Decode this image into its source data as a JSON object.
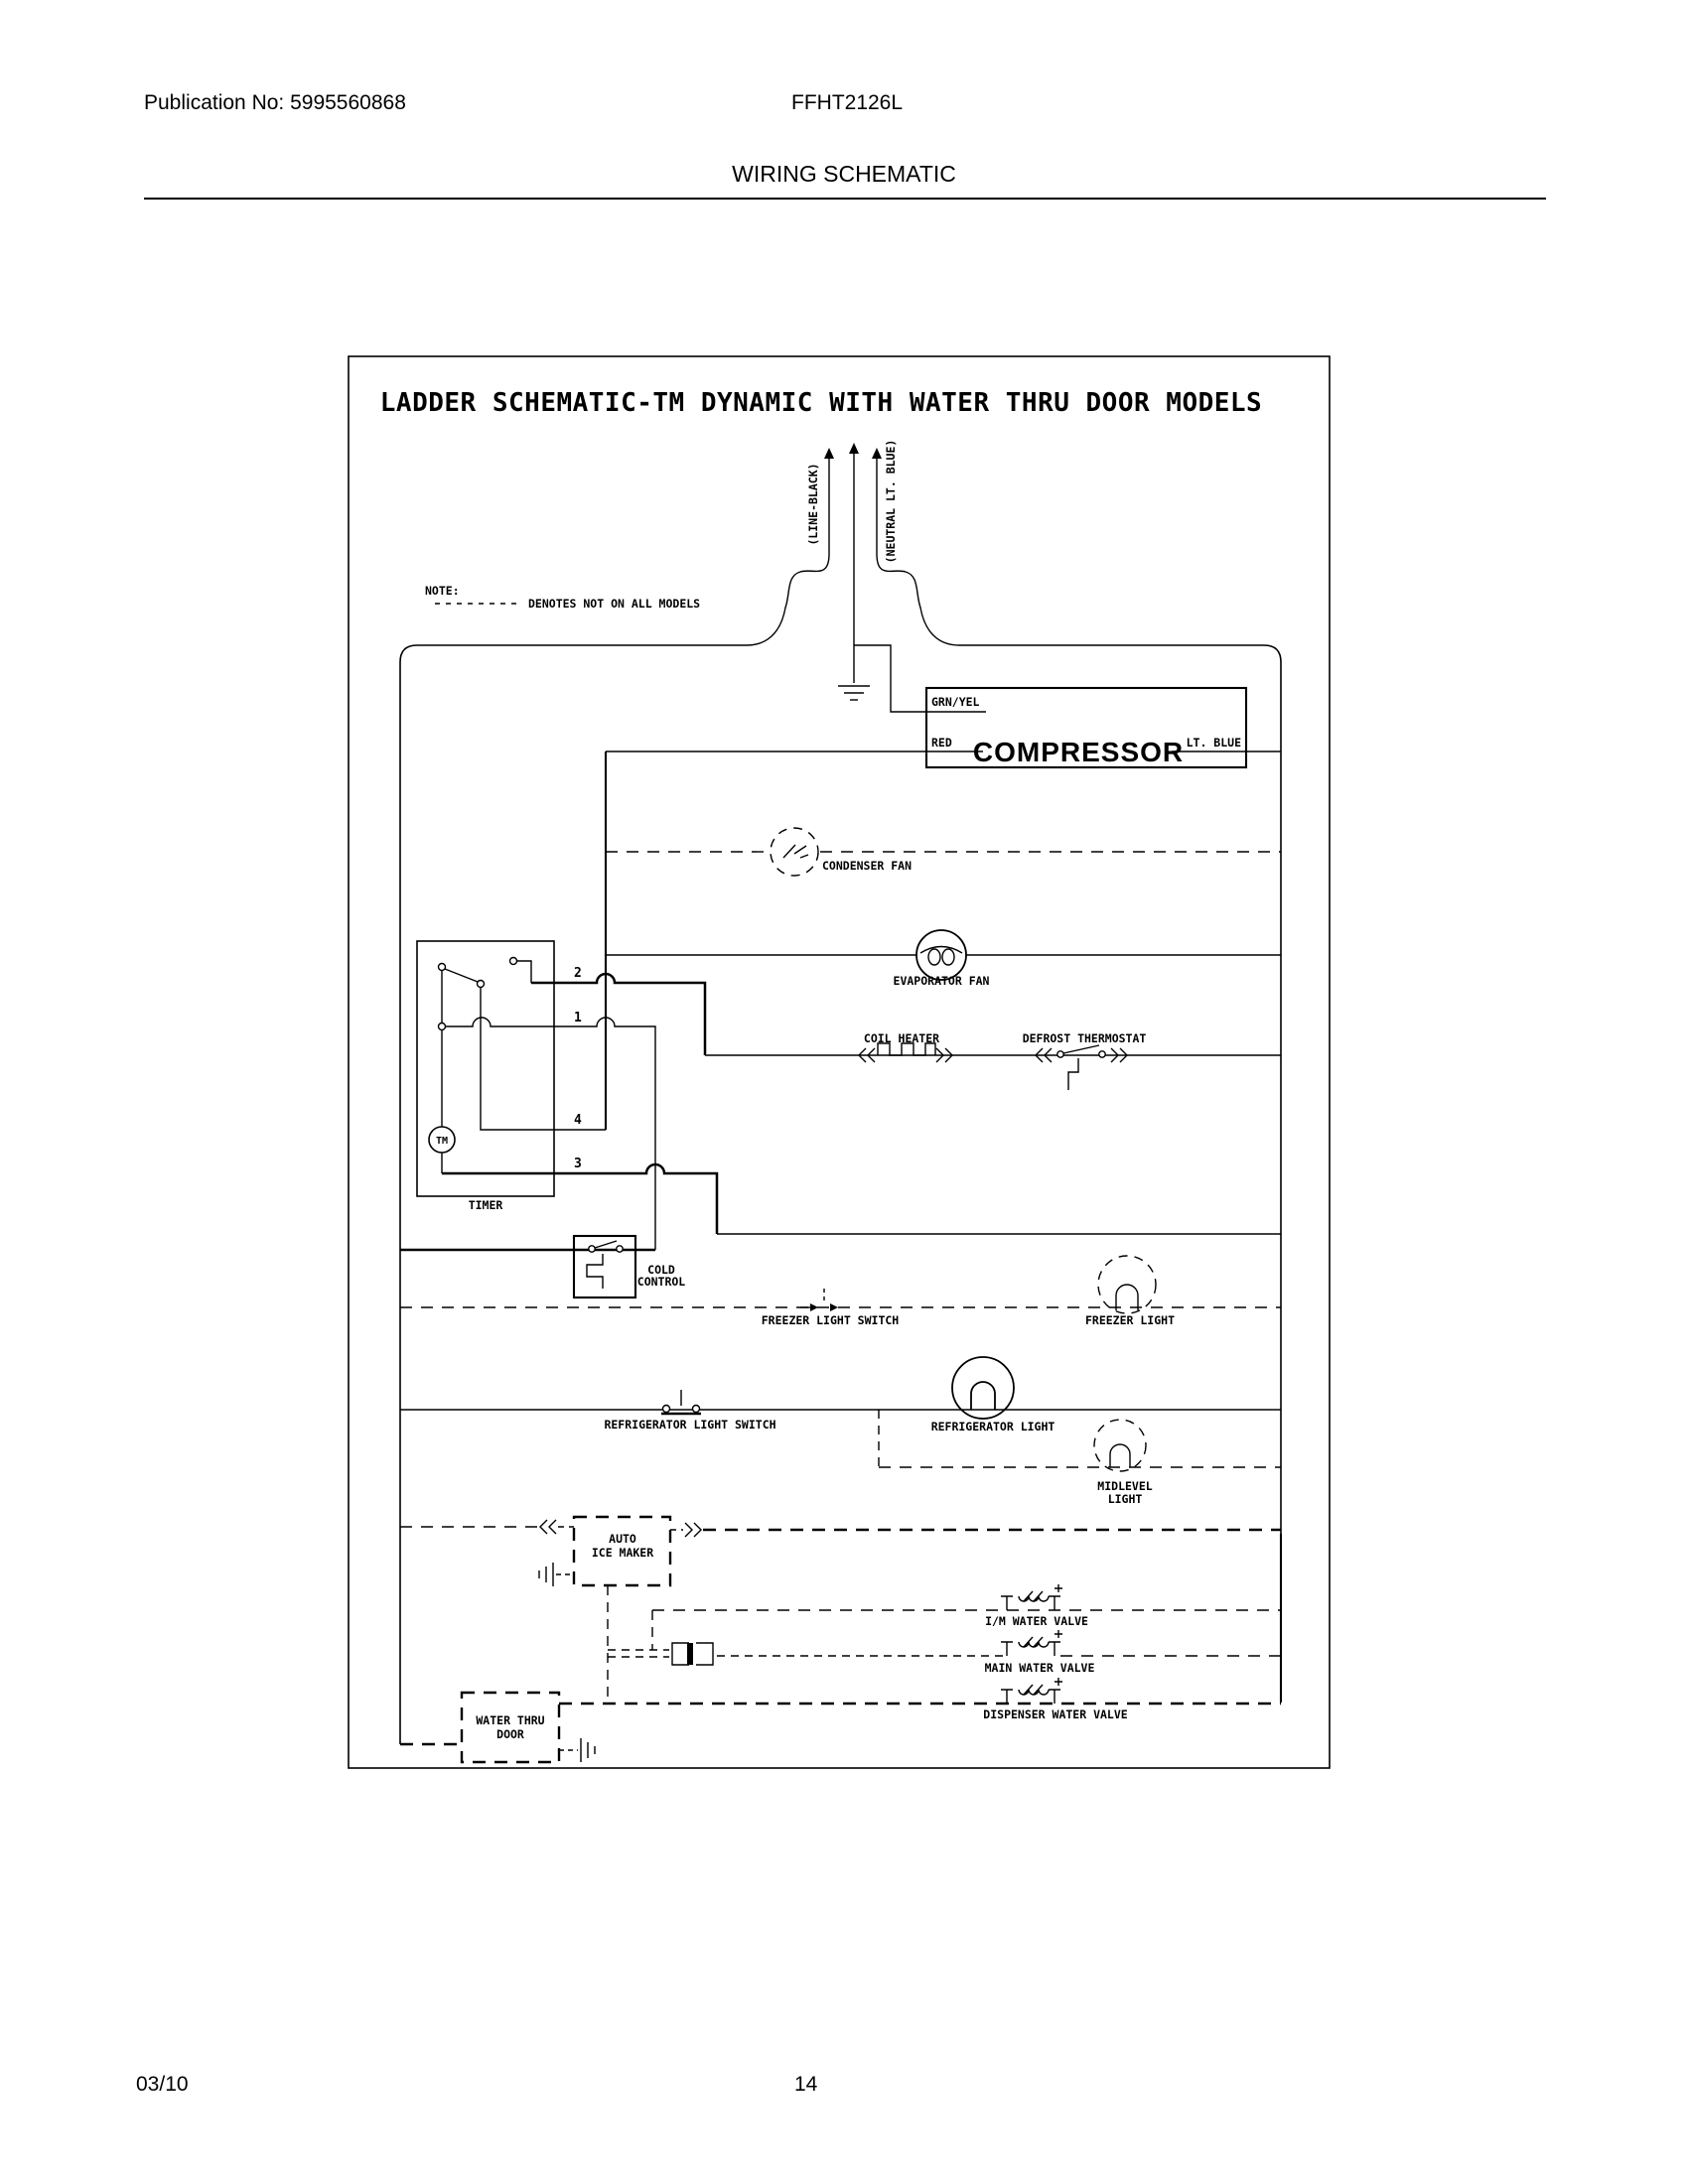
{
  "header": {
    "publication": "Publication No: 5995560868",
    "model": "FFHT2126L",
    "title": "WIRING SCHEMATIC"
  },
  "footer": {
    "date": "03/10",
    "page": "14"
  },
  "schematic": {
    "title": "LADDER SCHEMATIC-TM DYNAMIC WITH WATER THRU DOOR MODELS",
    "note": {
      "label": "NOTE:",
      "text": "DENOTES NOT ON ALL MODELS"
    },
    "supply": {
      "line": "(LINE-BLACK)",
      "neutral": "(NEUTRAL LT. BLUE)"
    },
    "compressor": {
      "name": "COMPRESSOR",
      "grn": "GRN/YEL",
      "red": "RED",
      "blue": "LT. BLUE"
    },
    "timer": {
      "name": "TIMER",
      "motor": "TM",
      "t2": "2",
      "t1": "1",
      "t4": "4",
      "t3": "3"
    },
    "labels": {
      "condenser_fan": "CONDENSER FAN",
      "evaporator_fan": "EVAPORATOR FAN",
      "coil_heater": "COIL HEATER",
      "defrost_thermostat": "DEFROST THERMOSTAT",
      "cold_control_1": "COLD",
      "cold_control_2": "CONTROL",
      "freezer_light_switch": "FREEZER LIGHT SWITCH",
      "freezer_light": "FREEZER LIGHT",
      "refrigerator_light_switch": "REFRIGERATOR LIGHT SWITCH",
      "refrigerator_light": "REFRIGERATOR LIGHT",
      "midlevel_1": "MIDLEVEL",
      "midlevel_2": "LIGHT",
      "ice_maker_1": "AUTO",
      "ice_maker_2": "ICE MAKER",
      "im_water_valve": "I/M WATER VALVE",
      "main_water_valve": "MAIN WATER VALVE",
      "dispenser_water_valve": "DISPENSER WATER VALVE",
      "water_thru_door_1": "WATER THRU",
      "water_thru_door_2": "DOOR"
    }
  }
}
